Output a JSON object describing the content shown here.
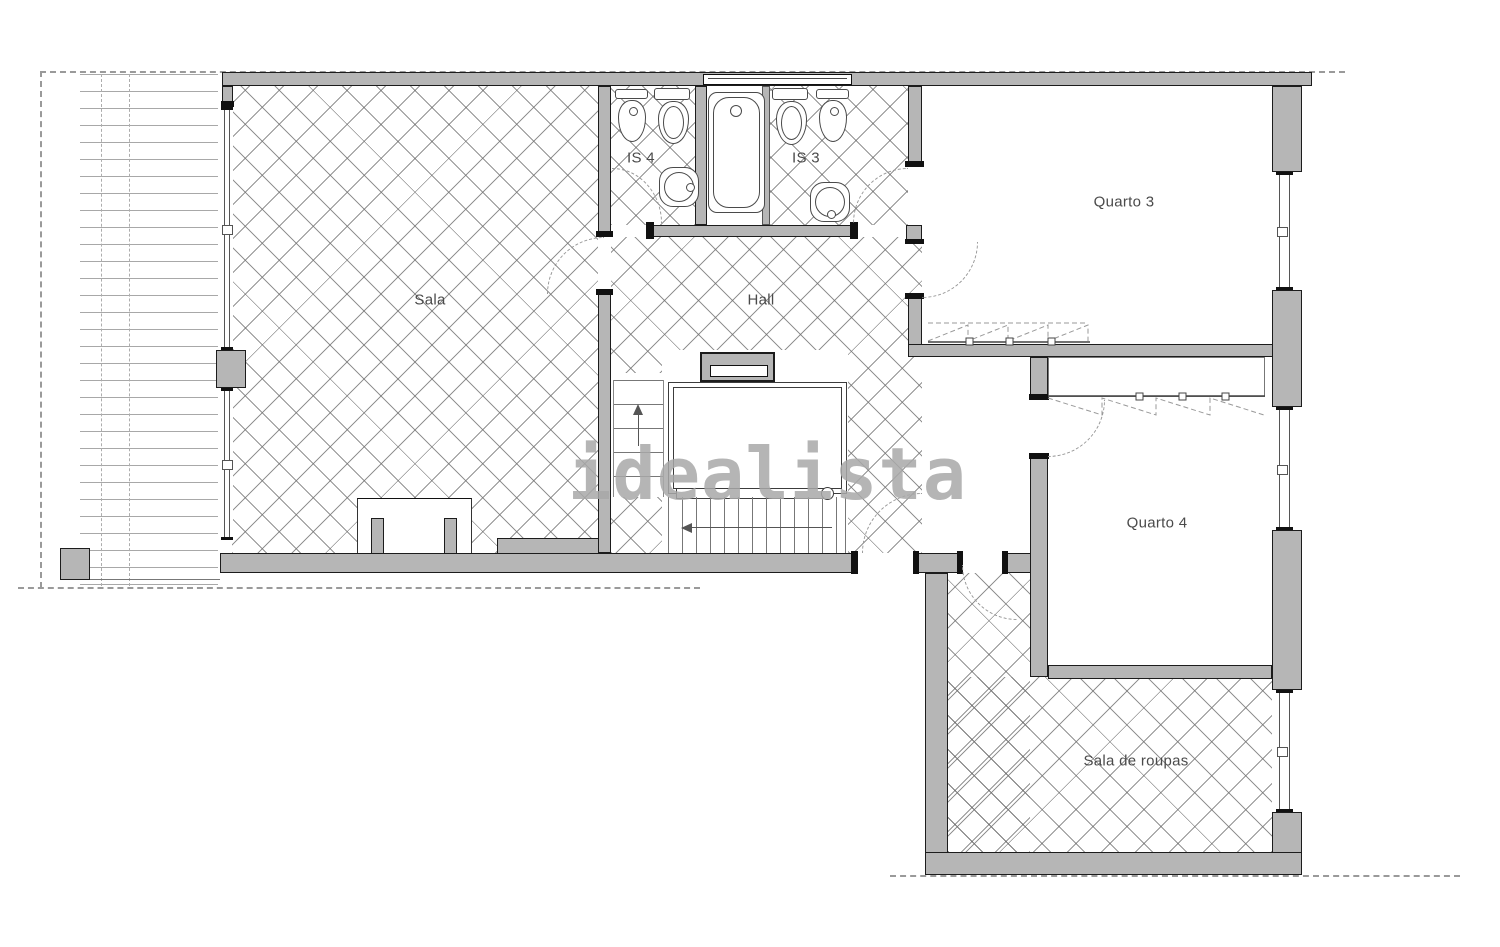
{
  "watermark": "idealista",
  "rooms": {
    "sala": "Sala",
    "hall": "Hall",
    "is4": "IS 4",
    "is3": "IS 3",
    "quarto3": "Quarto 3",
    "quarto4": "Quarto 4",
    "sala_de_roupas": "Sala de roupas"
  },
  "fixtures": {
    "is4": [
      "bidet",
      "toilet",
      "sink"
    ],
    "is3": [
      "toilet",
      "bidet",
      "sink",
      "bathtub"
    ],
    "stairs": "staircase-with-down-arrow-and-up-arrow",
    "fireplace": "fireplace",
    "wardrobes": [
      "quarto3-sliding-wardrobe",
      "quarto4-sliding-wardrobe"
    ]
  },
  "colors": {
    "wall_fill": "#b6b6b6",
    "wall_outline": "#1c1c1c",
    "hatch_line": "#6e6e6e",
    "boundary_dash": "#9a9a9a",
    "label_text": "#4a4a4a",
    "watermark_gray": "#a9a9a9",
    "background": "#ffffff"
  }
}
